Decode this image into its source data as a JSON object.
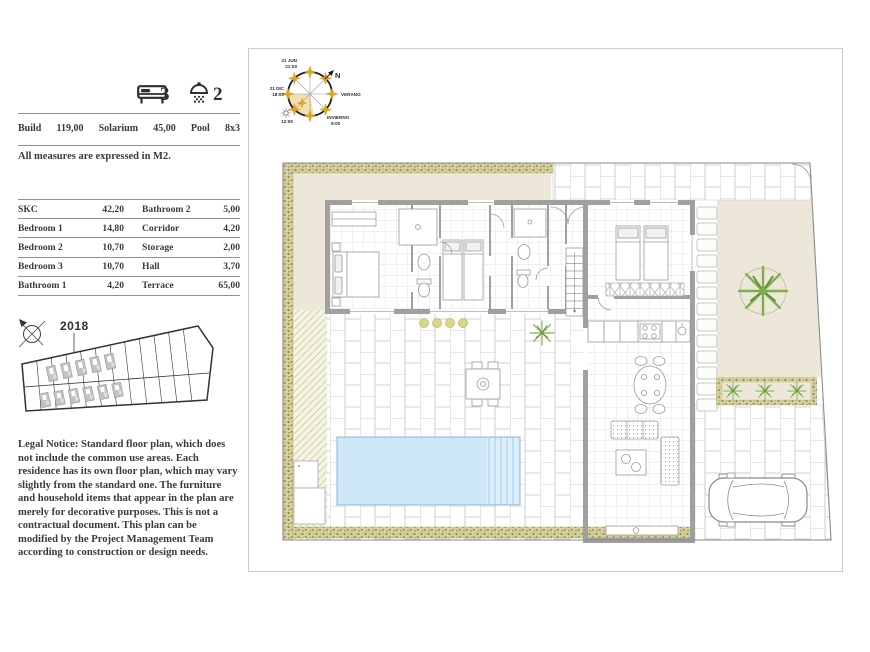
{
  "counts": {
    "bedrooms": "3",
    "bathrooms": "2"
  },
  "summary": {
    "items": [
      {
        "label": "Build",
        "value": "119,00"
      },
      {
        "label": "Solarium",
        "value": "45,00"
      },
      {
        "label": "Pool",
        "value": "8x3"
      }
    ],
    "measures_note": "All measures are expressed in M2."
  },
  "areas_table": {
    "rows": [
      {
        "left_label": "SKC",
        "left_value": "42,20",
        "right_label": "Bathroom 2",
        "right_value": "5,00"
      },
      {
        "left_label": "Bedroom 1",
        "left_value": "14,80",
        "right_label": "Corridor",
        "right_value": "4,20"
      },
      {
        "left_label": "Bedroom 2",
        "left_value": "10,70",
        "right_label": "Storage",
        "right_value": "2,00"
      },
      {
        "left_label": "Bedroom 3",
        "left_value": "10,70",
        "right_label": "Hall",
        "right_value": "3,70"
      },
      {
        "left_label": "Bathroom 1",
        "left_value": "4,20",
        "right_label": "Terrace",
        "right_value": "65,00"
      }
    ]
  },
  "site_plan": {
    "year_label": "2018"
  },
  "sun_diagram": {
    "summer_solstice_date": "21 JUN",
    "summer_solstice_time": "21:00",
    "north_label": "N",
    "winter_solstice_date": "21 DIC",
    "winter_solstice_time": "18:00",
    "summer_label": "VERANO",
    "winter_label": "INVIERNO",
    "winter_time": "9:00",
    "noon_time": "12:00"
  },
  "legal_notice": "Legal Notice: Standard floor plan, which does not include the common use areas. Each residence has its own floor plan, which may vary slightly from the standard one. The furniture and household items that appear in the plan are merely for decorative purposes. This is not a contractual document. This plan can be modified by the Project Management Team according to construction or design needs.",
  "colors": {
    "pool_water": "#cfe8f8",
    "garden_beige": "#ece7d8",
    "hedge_olive": "#b3aa6e",
    "plant_green": "#7fae4a",
    "sun_gold": "#e2a51b",
    "wall_gray": "#a0a0a0"
  }
}
